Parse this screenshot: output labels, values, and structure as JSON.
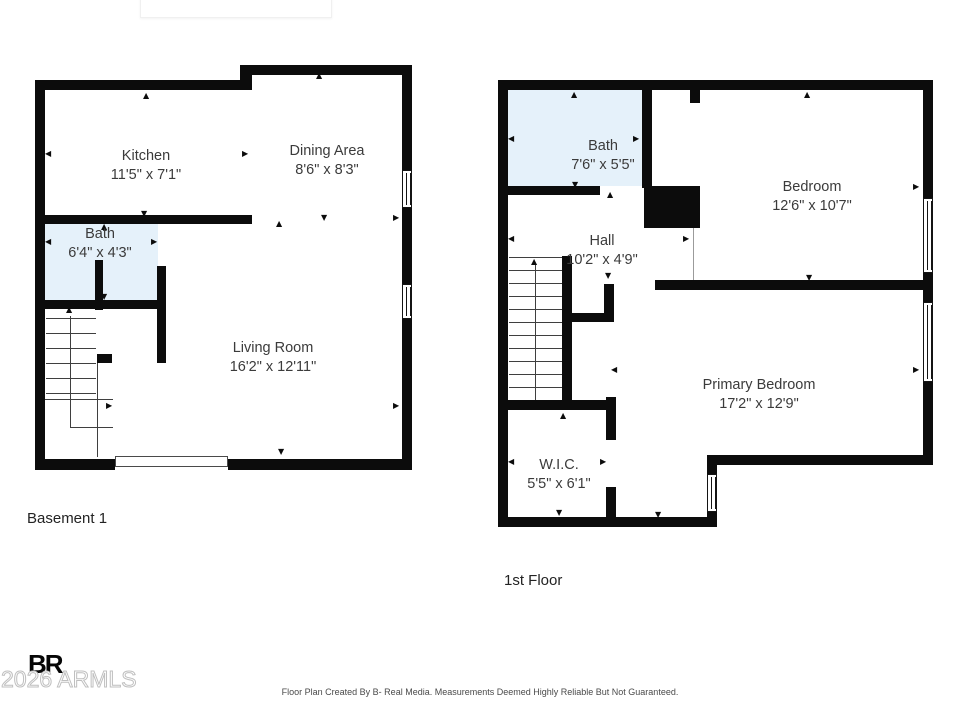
{
  "colors": {
    "wall": "#0c0c0c",
    "bath_fill": "#e5f1fa",
    "label_text": "#3b3b3b",
    "watermark_gray": "#bfbfbf"
  },
  "icons": {
    "arrow_up": "▲",
    "arrow_down": "▼",
    "arrow_left": "◀",
    "arrow_right": "▶"
  },
  "plans": {
    "basement": {
      "title": "Basement 1",
      "rooms": [
        {
          "name": "Kitchen",
          "dims": "11'5\" x 7'1\""
        },
        {
          "name": "Dining Area",
          "dims": "8'6\" x 8'3\""
        },
        {
          "name": "Bath",
          "dims": "6'4\" x 4'3\""
        },
        {
          "name": "Living Room",
          "dims": "16'2\" x 12'11\""
        }
      ]
    },
    "first_floor": {
      "title": "1st Floor",
      "rooms": [
        {
          "name": "Bath",
          "dims": "7'6\" x 5'5\""
        },
        {
          "name": "Bedroom",
          "dims": "12'6\" x 10'7\""
        },
        {
          "name": "Hall",
          "dims": "10'2\" x 4'9\""
        },
        {
          "name": "Primary Bedroom",
          "dims": "17'2\" x 12'9\""
        },
        {
          "name": "W.I.C.",
          "dims": "5'5\" x 6'1\""
        }
      ]
    }
  },
  "footer": {
    "logo": "BR",
    "watermark": "2026 ARMLS",
    "disclaimer": "Floor Plan Created By B- Real Media. Measurements Deemed Highly Reliable But Not Guaranteed."
  }
}
